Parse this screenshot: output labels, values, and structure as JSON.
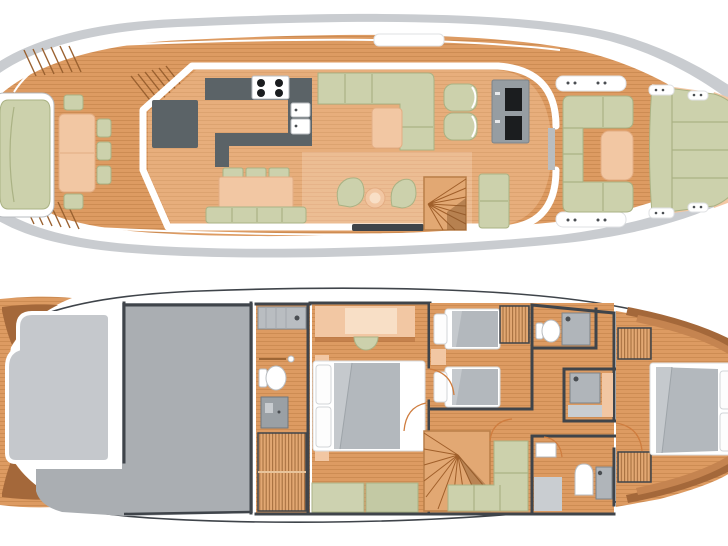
{
  "title": "yacht-two-deck-floor-plan",
  "palette": {
    "wood_deck": "#dd9b62",
    "wood_line": "#bf7f47",
    "wood_interior": "#e7ae7c",
    "wood_interior_line": "#d29764",
    "wood_lobby": "#ecbd93",
    "wood_lobby_line": "#dfa97f",
    "wood_dark_trim": "#a4683a",
    "wood_dark_trim2": "#c58450",
    "hull_gray": "#c9ccd0",
    "outline_dark": "#3f444a",
    "counter_dark": "#5b6367",
    "appliance_black": "#1b1d1f",
    "sage": "#ccd1ac",
    "sage_line": "#aab284",
    "peach": "#f2c7a3",
    "peach_dark": "#e3ad83",
    "peach_light": "#f8dfc6",
    "gray_mid": "#aaaeb2",
    "gray_light": "#c5c8cc",
    "duvet": "#b3b8bd",
    "duvet_light": "#c5c9cd",
    "fixture_gray": "#b0b5ba",
    "stairs_wood": "#e2a873",
    "stairs_line": "#8a5526",
    "fan_line": "#a05f2a",
    "fan_frame": "#b97f49",
    "steps_line": "#9a6130",
    "arc_orange": "#cf7d3f"
  },
  "decks": [
    {
      "id": "main-deck",
      "features": [
        "bow-sun-bench",
        "bow-dining-table",
        "dining-chairs",
        "foredeck-steps",
        "flybridge-steps",
        "helm-console",
        "galley-counter",
        "cooktop",
        "double-sink",
        "salon-sofa",
        "coffee-table",
        "armchairs",
        "tv-cabinet",
        "dinette-chairs",
        "dinette-table",
        "dinette-bench",
        "swivel-chairs",
        "pouf",
        "spiral-staircase",
        "aft-bench",
        "roof-hatch",
        "side-door",
        "aft-deck-seating",
        "aft-table",
        "mooring-cleats",
        "stern-sunpad",
        "swim-platform"
      ]
    },
    {
      "id": "lower-deck",
      "features": [
        "bow-locker",
        "engine-room",
        "day-head",
        "toilet",
        "wash-basin",
        "companionway-stairs",
        "vip-cabin",
        "vip-bed",
        "vanity",
        "stool",
        "bench",
        "twin-cabin",
        "twin-beds",
        "nightstand",
        "wardrobes",
        "forward-bathroom",
        "shower",
        "mid-shower-room",
        "aft-bathroom",
        "bath-mat",
        "spiral-staircase",
        "lounge-sofa",
        "master-cabin",
        "master-bed",
        "door-swings",
        "hull-outline"
      ]
    }
  ]
}
